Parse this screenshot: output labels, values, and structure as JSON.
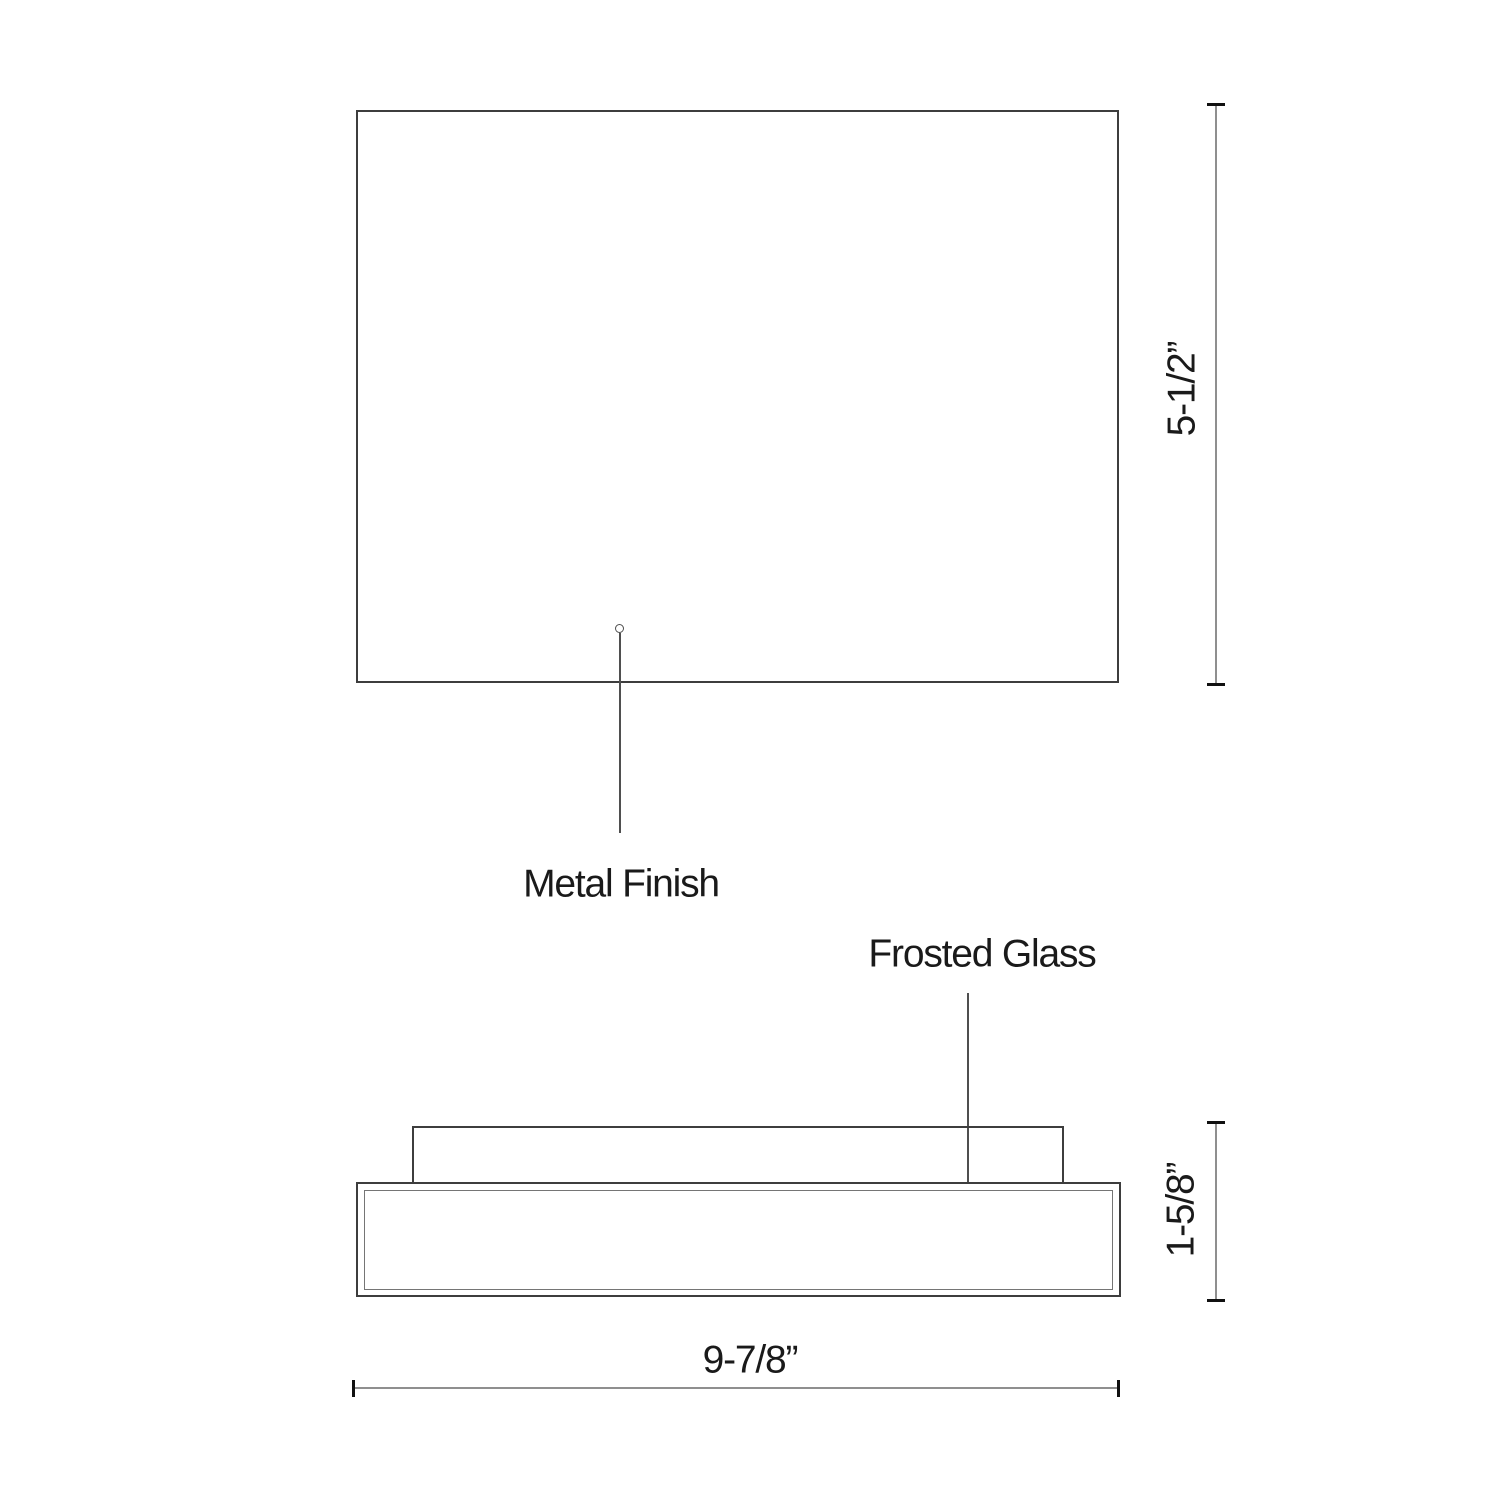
{
  "drawing": {
    "type": "technical-dimension-drawing",
    "views": {
      "front": {
        "callout": "Metal Finish"
      },
      "side": {
        "callout": "Frosted Glass"
      }
    },
    "dimensions": {
      "height": "5-1/2”",
      "depth": "1-5/8”",
      "width": "9-7/8”"
    }
  },
  "colors": {
    "background": "#ffffff",
    "outline": "#3d3d3d",
    "inner_line": "#757575",
    "dimension_line": "#8f8f8f",
    "leader": "#4f4f4f",
    "tick": "#111111",
    "text": "#1a1a1a"
  }
}
